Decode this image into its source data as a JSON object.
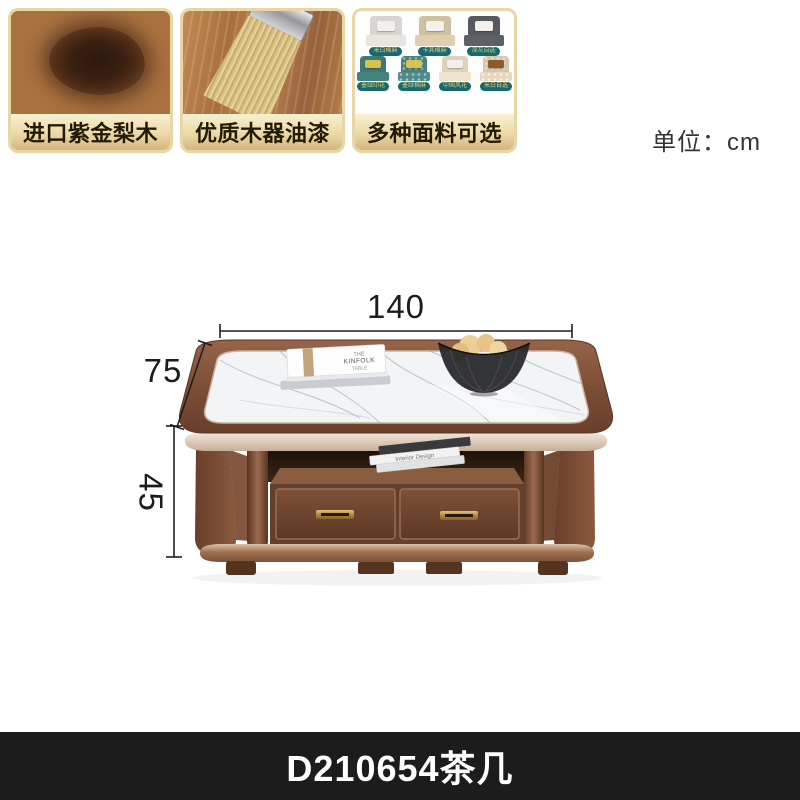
{
  "unit_label": "单位：cm",
  "dimensions": {
    "width": "140",
    "depth": "75",
    "height": "45",
    "unit": "cm"
  },
  "product": {
    "code_label": "D210654茶几",
    "type": "coffee-table"
  },
  "feature_cards": [
    {
      "label": "进口紫金梨木",
      "image": "wood-grain-cross-section"
    },
    {
      "label": "优质木器油漆",
      "image": "paint-brush-on-wood"
    },
    {
      "label": "多种面料可选",
      "image": "fabric-swatch-grid",
      "swatches": [
        {
          "label": "米白棉麻",
          "color": "#d8d5d0"
        },
        {
          "label": "卡其棉麻",
          "color": "#cfc0a0"
        },
        {
          "label": "深灰自选",
          "color": "#555a60"
        },
        {
          "label": "墨绿印花",
          "color": "#3f7878"
        },
        {
          "label": "墨绿棉麻",
          "color": "#4a8080"
        },
        {
          "label": "中国风花",
          "color": "#ddd2bc"
        },
        {
          "label": "米白自选",
          "color": "#d6c6ae"
        }
      ]
    }
  ],
  "decor": {
    "top_book_line1": "THE",
    "top_book_line2": "KINFOLK",
    "top_book_line3": "TABLE",
    "shelf_book_title": "Interior Design"
  },
  "colors": {
    "card_border_gold": "#e8d6a4",
    "card_label_gradient_top": "#f9f0d2",
    "card_label_gradient_bottom": "#d4b47e",
    "badge_teal": "#156a6e",
    "badge_text_gold": "#e9c97e",
    "wood_frame": "#7c4f36",
    "marble_top": "#f2f4f6",
    "brass_handle": "#c9a24a",
    "banner_background": "#1c1c1c",
    "banner_text": "#ffffff",
    "dimension_line": "#1e1e1e"
  }
}
